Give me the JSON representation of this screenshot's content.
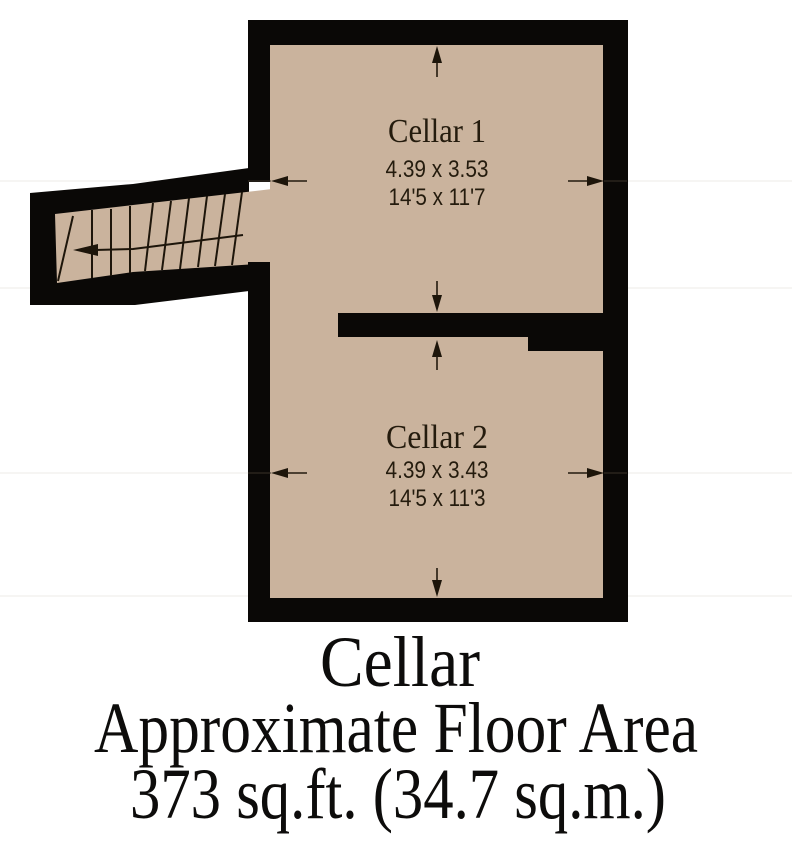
{
  "plan": {
    "type": "floor-plan",
    "floor_name": "Cellar",
    "rooms": [
      {
        "name": "Cellar 1",
        "metric_dims": "4.39 x 3.53",
        "imperial_dims": "14'5 x 11'7"
      },
      {
        "name": "Cellar 2",
        "metric_dims": "4.39 x 3.43",
        "imperial_dims": "14'5 x 11'3"
      }
    ],
    "features": [
      "staircase with winder steps",
      "direction arrow pointing left",
      "dimension arrows on all four sides of each room"
    ]
  },
  "footer": {
    "title": "Cellar",
    "subtitle": "Approximate Floor Area",
    "area": "373 sq.ft. (34.7 sq.m.)"
  },
  "colors": {
    "floor": "#cab39d",
    "wall": "#0a0806",
    "plan_text": "#241b0d",
    "footer_text": "#0d0c0b",
    "background": "#ffffff"
  }
}
